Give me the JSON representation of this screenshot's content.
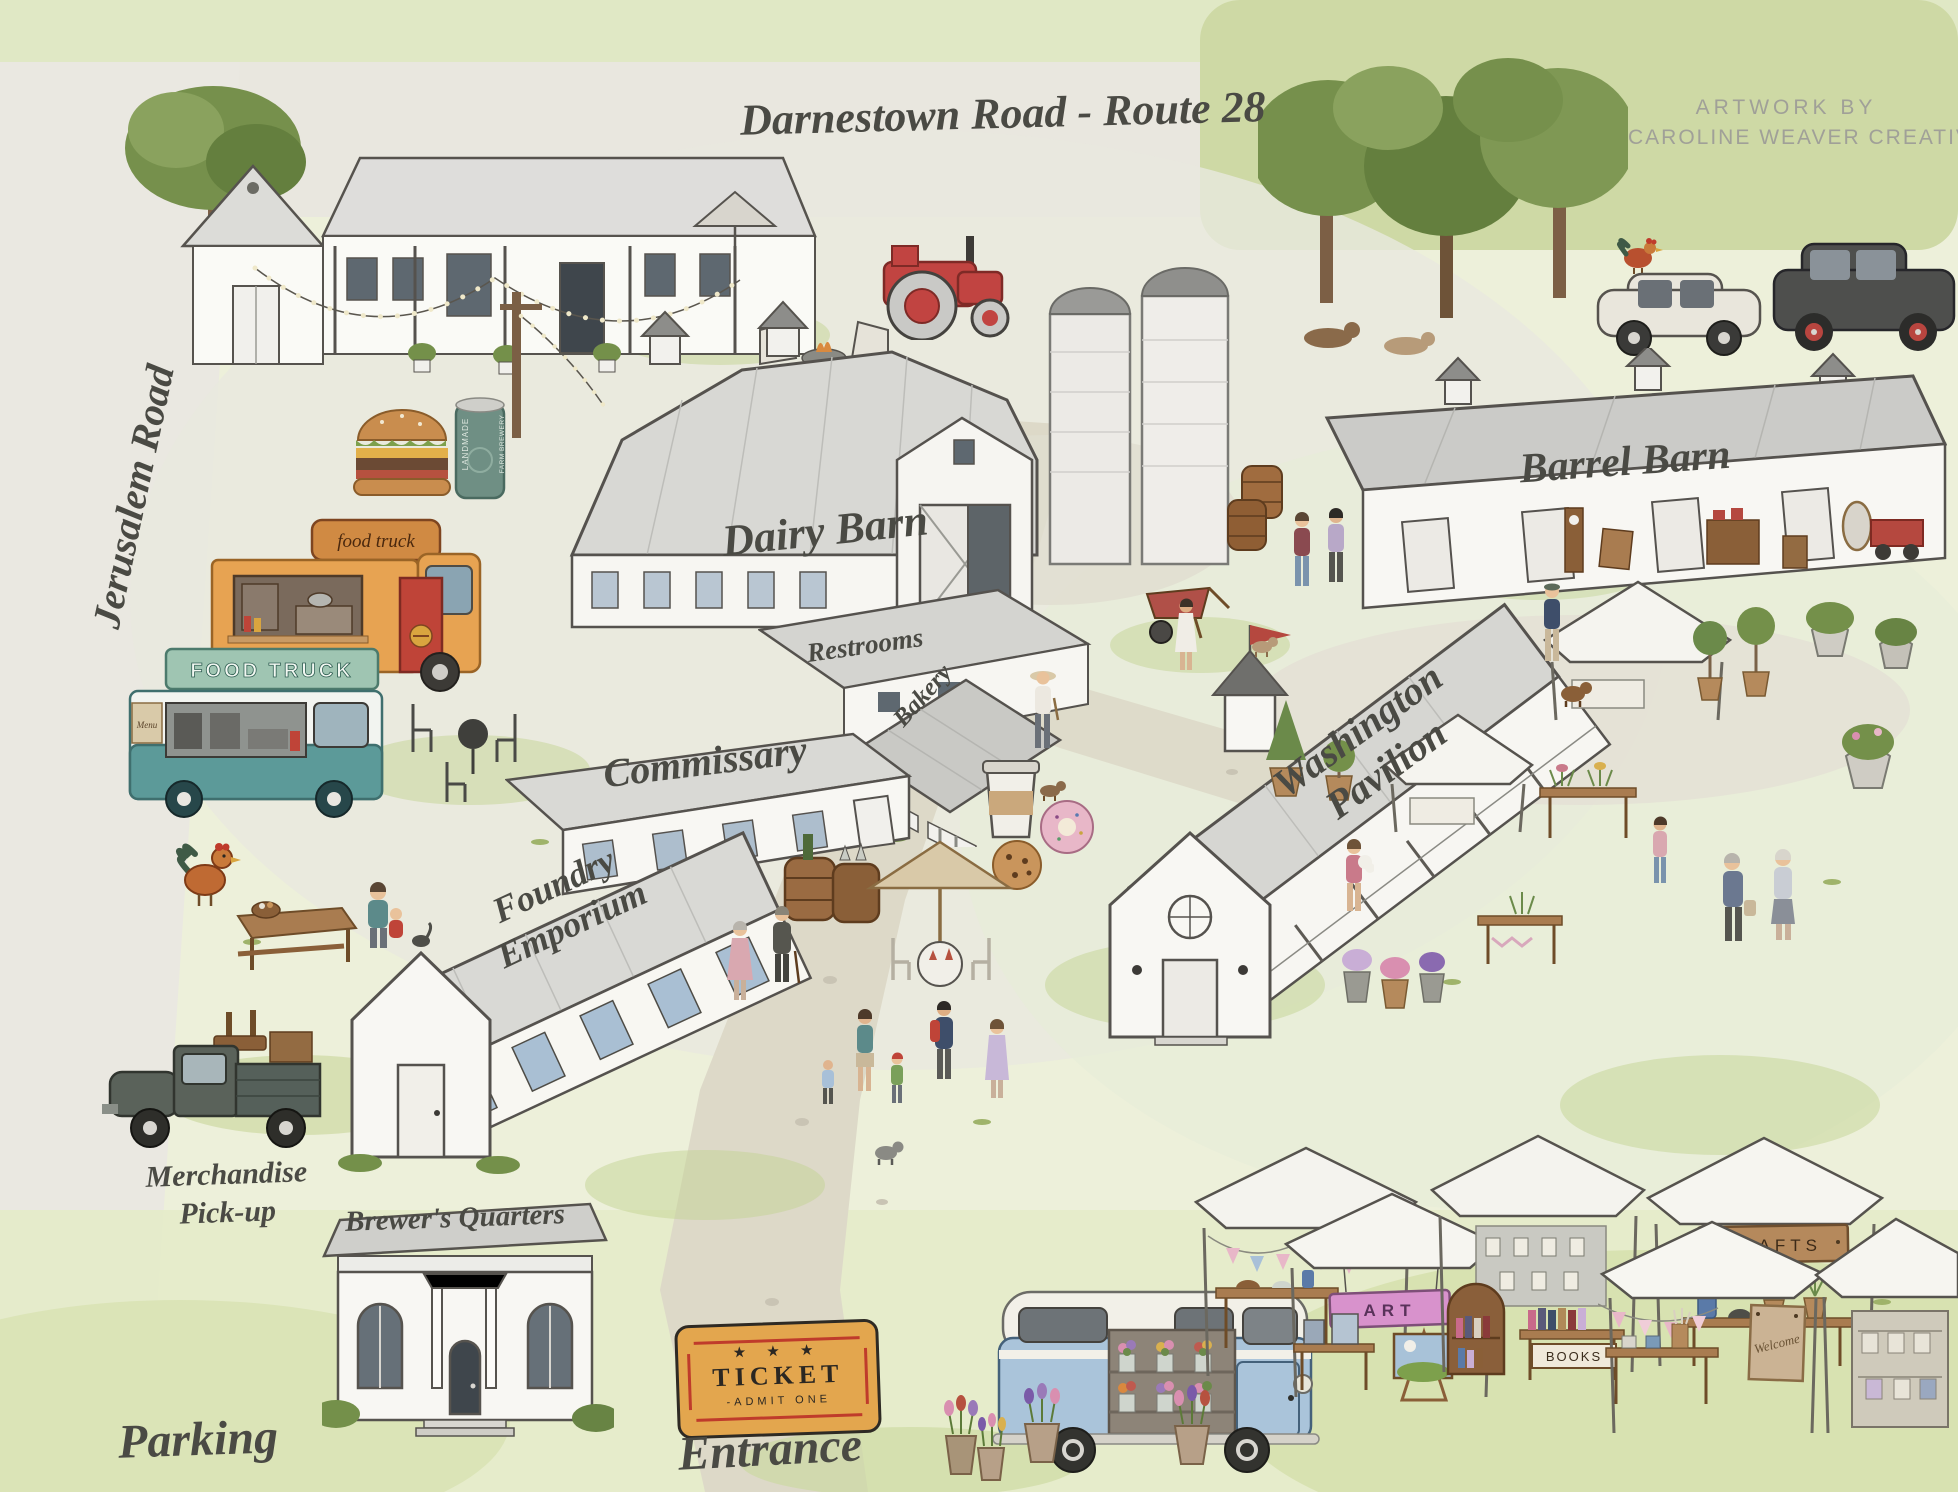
{
  "page": {
    "title": "Farm Market Illustrated Map"
  },
  "palette": {
    "background": "#edf0da",
    "road": "#e9e7df",
    "path": "#ddd9c8",
    "grass": "#c8d795",
    "tree": "#76904c",
    "building_white": "#f8f7f3",
    "roof_gray": "#d6d6d2",
    "ink": "#4a4a44",
    "ticket_orange": "#e3a64e",
    "ticket_red": "#bf3b2b",
    "truck_orange": "#e7a352",
    "truck_teal": "#5c9a99",
    "bus_blue": "#aac4da",
    "sign_pink": "#d892cc",
    "tractor_red": "#c14441"
  },
  "roads": {
    "top": "Darnestown Road - Route 28",
    "left": "Jerusalem Road"
  },
  "credit": {
    "line1": "Artwork By",
    "line2": "Caroline Weaver Creative"
  },
  "buildings": {
    "dairy_barn": "Dairy Barn",
    "barrel_barn": "Barrel Barn",
    "restrooms": "Restrooms",
    "bakery": "Bakery",
    "commissary": "Commissary",
    "washington_pavilion": {
      "line1": "Washington",
      "line2": "Pavilion"
    },
    "foundry_emporium": {
      "line1": "Foundry",
      "line2": "Emporium"
    },
    "brewers_quarters": "Brewer's Quarters"
  },
  "vehicles": {
    "orange_food_truck_sign": "food truck",
    "teal_food_truck_sign": "FOOD TRUCK",
    "teal_food_truck_menu": "Menu"
  },
  "areas": {
    "merchandise_line1": "Merchandise",
    "merchandise_line2": "Pick-up",
    "parking": "Parking",
    "entrance": "Entrance"
  },
  "ticket": {
    "stars": "★ ★ ★",
    "title": "TICKET",
    "subtitle": "-ADMIT ONE"
  },
  "stalls": {
    "art": "ART",
    "books": "BOOKS",
    "crafts": "CRAFTS",
    "welcome": "Welcome"
  },
  "beer_can": {
    "line1": "LANDMADE",
    "line2": "FARM BREWERY"
  }
}
